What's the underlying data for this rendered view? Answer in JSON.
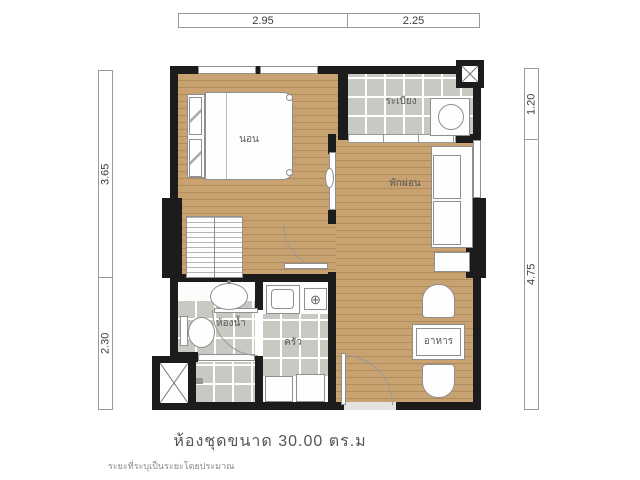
{
  "unit": {
    "title": "ห้องชุดขนาด  30.00  ตร.ม",
    "disclaimer": "ระยะที่ระบุเป็นระยะโดยประมาณ"
  },
  "dimensions": {
    "top": [
      "2.95",
      "2.25"
    ],
    "left": [
      "3.65",
      "2.30"
    ],
    "right": [
      "1.20",
      "4.75"
    ]
  },
  "rooms": {
    "bedroom": "นอน",
    "balcony": "ระเบียง",
    "living": "พักผ่อน",
    "bathroom": "ห้องน้ำ",
    "kitchen": "ครัว",
    "dining": "อาหาร"
  },
  "symbols": {
    "stove": "⊕"
  },
  "colors": {
    "wall": "#1c1c1c",
    "wood_floor": "#c9a271",
    "tile_floor": "#c9c8c3",
    "furniture_outline": "#8f8f8f",
    "dimension_text": "#3c3c3c",
    "label_text": "#5a5a5a"
  }
}
